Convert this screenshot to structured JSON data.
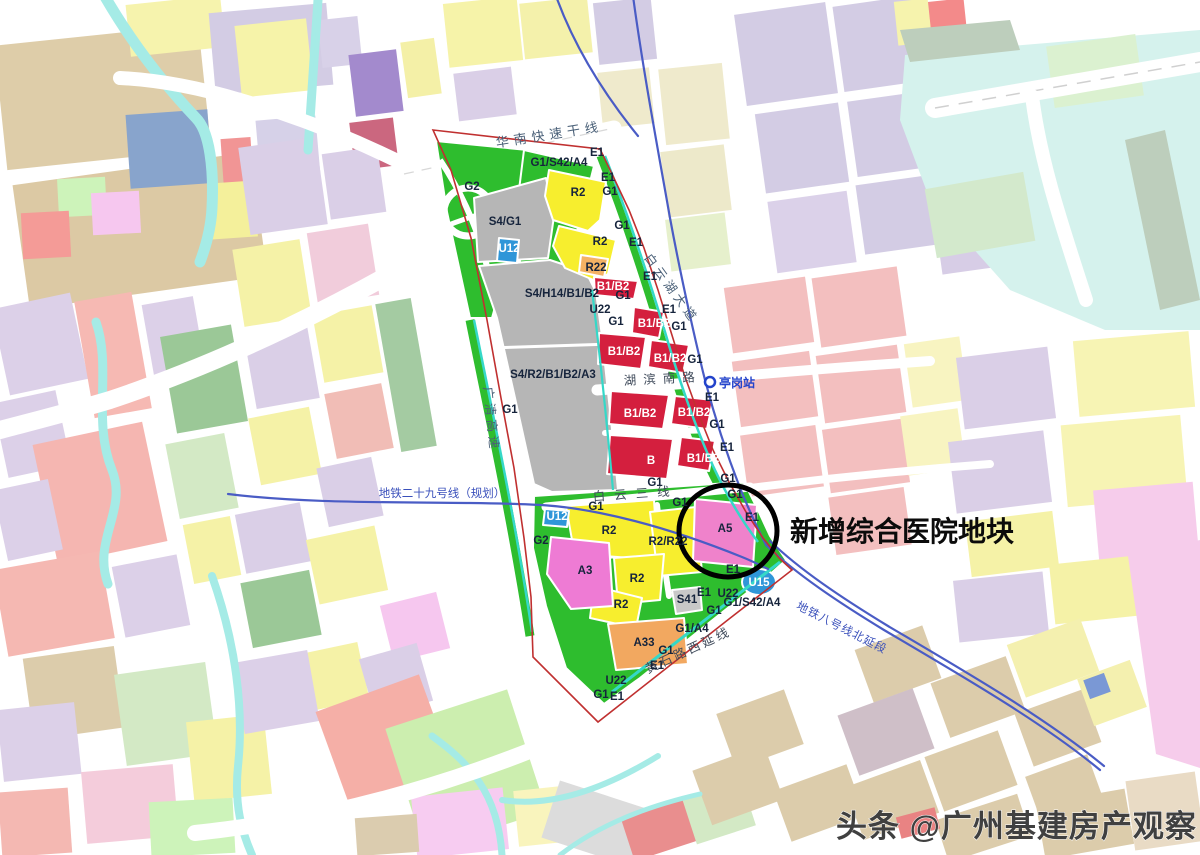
{
  "annotation": {
    "text": "新增综合医院地块"
  },
  "watermark": {
    "text": "头条 @广州基建房产观察"
  },
  "station": {
    "name": "亭岗站"
  },
  "palette": {
    "park_green": "#2ebd2e",
    "residential_yellow": "#f7ee2e",
    "commercial_red": "#d41f3e",
    "transport_gray": "#b6b6b6",
    "hospital_pink": "#ef82cb",
    "culture_pink": "#ee7bd4",
    "orange": "#f2a860",
    "utility_blue": "#2f96d8",
    "canal_cyan": "#35d8c8",
    "boundary_red": "#c03030",
    "metro_blue": "#4a5cc5",
    "circle_black": "#000000"
  },
  "map_labels": [
    {
      "t": "华南快速干线",
      "x": 550,
      "y": 139,
      "r": -9,
      "ls": 5,
      "s": 13,
      "f": "#4a6078",
      "w": 400,
      "n": "road-label-huanan-expressway"
    },
    {
      "t": "广清高速",
      "x": 487,
      "y": 420,
      "r": 84,
      "ls": 4,
      "s": 12.5,
      "f": "#4a6078",
      "w": 400,
      "n": "road-label-guangqing-expressway"
    },
    {
      "t": "白云湖大道",
      "x": 668,
      "y": 291,
      "r": 54,
      "ls": 4,
      "s": 12.5,
      "f": "#4a6078",
      "w": 400,
      "n": "road-label-baiyunhu-avenue"
    },
    {
      "t": "湖滨南路",
      "x": 663,
      "y": 383,
      "r": -3,
      "ls": 7,
      "s": 12.5,
      "f": "#3f4a5a",
      "w": 400,
      "n": "road-label-hubin-south-road"
    },
    {
      "t": "白云三线",
      "x": 636,
      "y": 498,
      "r": -4,
      "ls": 9,
      "s": 12.5,
      "f": "#3f4a5a",
      "w": 400,
      "n": "road-label-baiyun-third-line"
    },
    {
      "t": "黄石路西延线",
      "x": 690,
      "y": 654,
      "r": -25,
      "ls": 3,
      "s": 12.5,
      "f": "#3f4a5a",
      "w": 400,
      "n": "road-label-huangshi-west-extension"
    },
    {
      "t": "地铁二十九号线（规划）",
      "x": 442,
      "y": 497,
      "s": 11.5,
      "f": "#3a50bb",
      "w": 400,
      "n": "metro-line-29-label"
    },
    {
      "t": "地铁八号线北延段",
      "x": 840,
      "y": 631,
      "r": 27,
      "ls": 1,
      "s": 11.5,
      "f": "#3a50bb",
      "w": 400,
      "n": "metro-line-8-label"
    },
    {
      "t": "亭岗站",
      "x": 719,
      "y": 387,
      "s": 12,
      "f": "#2343cb",
      "w": 600,
      "a": "start",
      "n": "station-label-tinggang"
    },
    {
      "t": "E1",
      "x": 597,
      "y": 156
    },
    {
      "t": "G1/S42/A4",
      "x": 559,
      "y": 166
    },
    {
      "t": "G2",
      "x": 472,
      "y": 190
    },
    {
      "t": "R2",
      "x": 578,
      "y": 196
    },
    {
      "t": "E1",
      "x": 608,
      "y": 181
    },
    {
      "t": "G1",
      "x": 610,
      "y": 195
    },
    {
      "t": "S4/G1",
      "x": 505,
      "y": 225
    },
    {
      "t": "G1",
      "x": 622,
      "y": 229
    },
    {
      "t": "R2",
      "x": 600,
      "y": 245
    },
    {
      "t": "E1",
      "x": 636,
      "y": 246
    },
    {
      "t": "U12",
      "x": 509,
      "y": 252,
      "f": "#ffffff"
    },
    {
      "t": "R22",
      "x": 596,
      "y": 271
    },
    {
      "t": "B1/B2",
      "x": 613,
      "y": 290,
      "f": "#ffffff"
    },
    {
      "t": "E1",
      "x": 650,
      "y": 280
    },
    {
      "t": "G1",
      "x": 623,
      "y": 299
    },
    {
      "t": "S4/H14/B1/B2",
      "x": 562,
      "y": 297
    },
    {
      "t": "U22",
      "x": 600,
      "y": 313
    },
    {
      "t": "G1",
      "x": 616,
      "y": 325
    },
    {
      "t": "E1",
      "x": 669,
      "y": 313
    },
    {
      "t": "B1/B2",
      "x": 654,
      "y": 327,
      "f": "#ffffff"
    },
    {
      "t": "G1",
      "x": 679,
      "y": 330
    },
    {
      "t": "B1/B2",
      "x": 624,
      "y": 355,
      "f": "#ffffff"
    },
    {
      "t": "B1/B2",
      "x": 670,
      "y": 362,
      "f": "#ffffff"
    },
    {
      "t": "G1",
      "x": 695,
      "y": 363
    },
    {
      "t": "S4/R2/B1/B2/A3",
      "x": 553,
      "y": 378
    },
    {
      "t": "G1",
      "x": 510,
      "y": 413
    },
    {
      "t": "E1",
      "x": 712,
      "y": 401
    },
    {
      "t": "B1/B2",
      "x": 640,
      "y": 417,
      "f": "#ffffff"
    },
    {
      "t": "B1/B2",
      "x": 694,
      "y": 416,
      "f": "#ffffff"
    },
    {
      "t": "G1",
      "x": 717,
      "y": 428
    },
    {
      "t": "E1",
      "x": 727,
      "y": 451
    },
    {
      "t": "B",
      "x": 651,
      "y": 464,
      "f": "#ffffff"
    },
    {
      "t": "B1/B2",
      "x": 703,
      "y": 462,
      "f": "#ffffff"
    },
    {
      "t": "G1",
      "x": 655,
      "y": 486
    },
    {
      "t": "G1",
      "x": 728,
      "y": 482
    },
    {
      "t": "G1",
      "x": 735,
      "y": 498
    },
    {
      "t": "G1",
      "x": 596,
      "y": 510
    },
    {
      "t": "G1",
      "x": 680,
      "y": 506
    },
    {
      "t": "U12",
      "x": 557,
      "y": 520,
      "f": "#ffffff"
    },
    {
      "t": "R2",
      "x": 609,
      "y": 534
    },
    {
      "t": "R2/R22",
      "x": 668,
      "y": 545
    },
    {
      "t": "A5",
      "x": 725,
      "y": 532
    },
    {
      "t": "E1",
      "x": 752,
      "y": 521
    },
    {
      "t": "G2",
      "x": 541,
      "y": 544
    },
    {
      "t": "A3",
      "x": 585,
      "y": 574
    },
    {
      "t": "R2",
      "x": 637,
      "y": 582
    },
    {
      "t": "E1",
      "x": 733,
      "y": 573
    },
    {
      "t": "R2",
      "x": 621,
      "y": 608
    },
    {
      "t": "U15",
      "x": 759,
      "y": 586,
      "f": "#ffffff"
    },
    {
      "t": "E1",
      "x": 704,
      "y": 596
    },
    {
      "t": "U22",
      "x": 728,
      "y": 597
    },
    {
      "t": "S41",
      "x": 687,
      "y": 603
    },
    {
      "t": "G1/S42/A4",
      "x": 752,
      "y": 606
    },
    {
      "t": "G1",
      "x": 714,
      "y": 614
    },
    {
      "t": "G1/A4",
      "x": 692,
      "y": 632
    },
    {
      "t": "A33",
      "x": 644,
      "y": 646
    },
    {
      "t": "G1",
      "x": 666,
      "y": 654
    },
    {
      "t": "E1",
      "x": 657,
      "y": 669
    },
    {
      "t": "U22",
      "x": 616,
      "y": 684
    },
    {
      "t": "G1",
      "x": 601,
      "y": 698
    },
    {
      "t": "E1",
      "x": 617,
      "y": 700
    }
  ]
}
